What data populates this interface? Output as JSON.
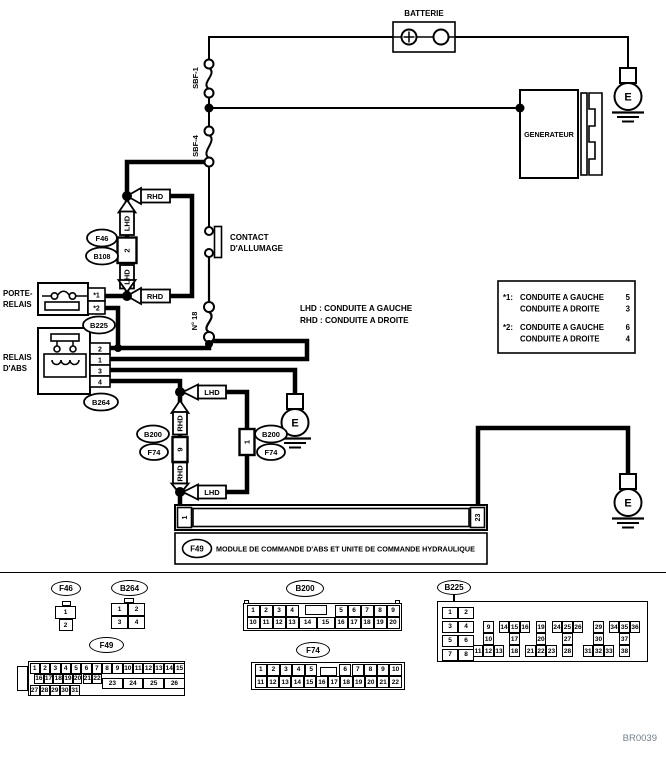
{
  "diagram": {
    "code": "BR0039",
    "ground": {
      "label": "E"
    },
    "battery": {
      "label": "BATTERIE"
    },
    "generator": {
      "label": "GENERATEUR"
    },
    "fuses": {
      "sbf1": "SBF-1",
      "sbf4": "SBF-4",
      "no18": "N° 18"
    },
    "ignition": {
      "line1": "CONTACT",
      "line2": "D'ALLUMAGE"
    },
    "porte_relais": {
      "line1": "PORTE-",
      "line2": "RELAIS",
      "t1": "*1",
      "t2": "*2"
    },
    "relais_abs": {
      "line1": "RELAIS",
      "line2": "D'ABS",
      "pins": [
        "2",
        "1",
        "3",
        "4"
      ]
    },
    "module": {
      "label": "MODULE DE COMMANDE D'ABS ET UNITE DE COMMANDE HYDRAULIQUE",
      "pin_left": "1",
      "pin_right": "23"
    },
    "legend_inline": {
      "line1": "LHD : CONDUITE A GAUCHE",
      "line2": "RHD : CONDUITE A DROITE"
    },
    "legend_box": {
      "e1": "*1:",
      "g1": "CONDUITE A GAUCHE",
      "v1": "5",
      "d1": "CONDUITE A DROITE",
      "v2": "3",
      "e2": "*2:",
      "g2": "CONDUITE A GAUCHE",
      "v3": "6",
      "d2": "CONDUITE A DROITE",
      "v4": "4"
    },
    "branch": {
      "lhd": "LHD",
      "rhd": "RHD",
      "conn_top": "2",
      "conn_left": "9",
      "conn_right": "1"
    },
    "refs": {
      "f46": "F46",
      "b108": "B108",
      "b225": "B225",
      "b264": "B264",
      "b200": "B200",
      "f74": "F74",
      "f49": "F49"
    }
  },
  "pinouts": {
    "f46": {
      "ref": "F46",
      "cells": [
        "1",
        "2"
      ]
    },
    "b264": {
      "ref": "B264",
      "rows": [
        [
          "1",
          "2"
        ],
        [
          "3",
          "4"
        ]
      ]
    },
    "b200": {
      "ref": "B200",
      "top_left": [
        "1",
        "2",
        "3",
        "4"
      ],
      "top_right": [
        "5",
        "6",
        "7",
        "8",
        "9"
      ],
      "bottom_left": [
        "10",
        "11",
        "12",
        "13"
      ],
      "bottom_wide": [
        "14",
        "15"
      ],
      "bottom_right": [
        "16",
        "17",
        "18",
        "19",
        "20"
      ]
    },
    "b225": {
      "ref": "B225",
      "pairs": [
        [
          "1",
          "2"
        ],
        [
          "3",
          "4"
        ],
        [
          "5",
          "6"
        ],
        [
          "7",
          "8"
        ]
      ],
      "groups": [
        {
          "top": [
            "9"
          ],
          "mid": [
            "10"
          ],
          "bot": [
            "11",
            "12",
            "13"
          ]
        },
        {
          "top": [
            "14",
            "15",
            "16"
          ],
          "mid": [
            "17"
          ],
          "bot": [
            "18"
          ]
        },
        {
          "top": [
            "19"
          ],
          "mid": [
            "20"
          ],
          "bot": [
            "21",
            "22",
            "23"
          ]
        },
        {
          "top": [
            "24",
            "25",
            "26"
          ],
          "mid": [
            "27"
          ],
          "bot": [
            "28"
          ]
        },
        {
          "top": [
            "29"
          ],
          "mid": [
            "30"
          ],
          "bot": [
            "31",
            "32",
            "33"
          ]
        },
        {
          "top": [
            "34",
            "35",
            "36"
          ],
          "mid": [
            "37"
          ],
          "bot": [
            "38"
          ]
        }
      ]
    },
    "f49": {
      "ref": "F49",
      "row1": [
        "1",
        "2",
        "3",
        "4",
        "5",
        "6",
        "7",
        "8",
        "9",
        "10",
        "11",
        "12",
        "13",
        "14",
        "15"
      ],
      "row2": [
        "16",
        "17",
        "18",
        "19",
        "20",
        "21",
        "22"
      ],
      "wide": [
        "23",
        "24",
        "25",
        "26"
      ],
      "row3": [
        "27",
        "28",
        "29",
        "30",
        "31"
      ]
    },
    "f74": {
      "ref": "F74",
      "top_left": [
        "1",
        "2",
        "3",
        "4",
        "5"
      ],
      "top_right": [
        "6",
        "7",
        "8",
        "9",
        "10"
      ],
      "bottom": [
        "11",
        "12",
        "13",
        "14",
        "15",
        "16",
        "17",
        "18",
        "19",
        "20",
        "21",
        "22"
      ]
    }
  }
}
